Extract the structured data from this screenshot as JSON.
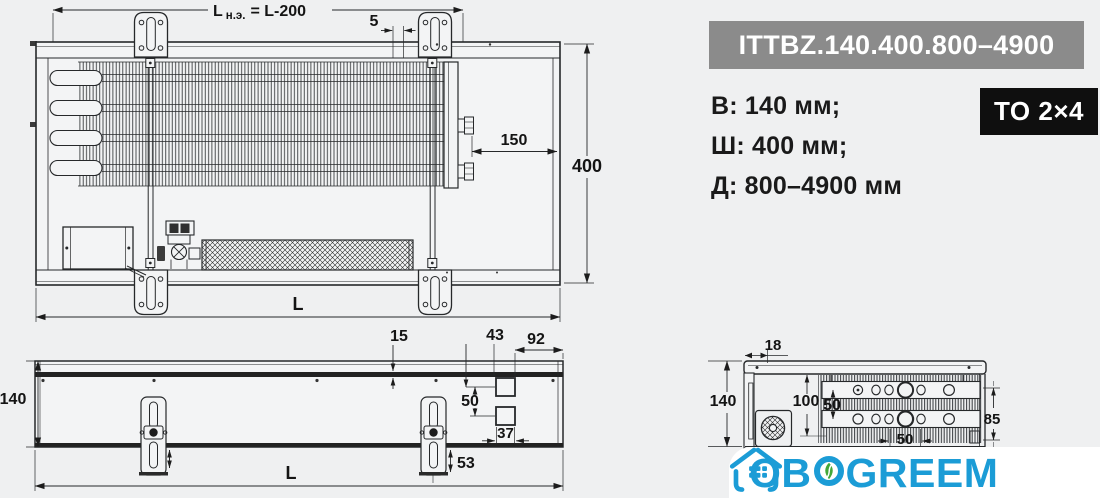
{
  "colors": {
    "background": "#eff0f1",
    "drawing_line": "#26282a",
    "title_bar_bg": "#8b8b8b",
    "badge_bg": "#0f0f0f",
    "band_bg": "#ffffff",
    "brand_blue": "#1b9cd6",
    "brand_green": "#42a839"
  },
  "header": {
    "model_title": "ITTBZ.140.400.800–4900",
    "badge_label": "TO 2×4"
  },
  "specs": {
    "items": [
      {
        "label": "В: 140 мм;"
      },
      {
        "label": "Ш: 400 мм;"
      },
      {
        "label": "Д: 800–4900 мм"
      }
    ]
  },
  "brand": {
    "name": "OBOGREEM",
    "text_before_leaf": "OB",
    "text_after_leaf": "GREEM"
  },
  "drawing": {
    "top_view": {
      "dim_element_length_prefix": "L",
      "dim_element_length_sub": "н.э.",
      "dim_element_length_value": "= L-200",
      "dim_bracket_offset": "5",
      "dim_fitting_to_edge": "150",
      "dim_depth": "400",
      "dim_length": "L"
    },
    "front_view": {
      "dim_height": "140",
      "dim_grille": "15",
      "dim_hole_top": "43",
      "dim_hole_right": "92",
      "dim_hole_gap": "50",
      "dim_hole_width": "37",
      "dim_foot_drop": "53",
      "dim_length": "L"
    },
    "section_view": {
      "dim_inset": "18",
      "dim_height": "140",
      "dim_core": "100",
      "dim_row_gap": "50",
      "dim_side": "85",
      "dim_tube_gap": "50"
    }
  }
}
